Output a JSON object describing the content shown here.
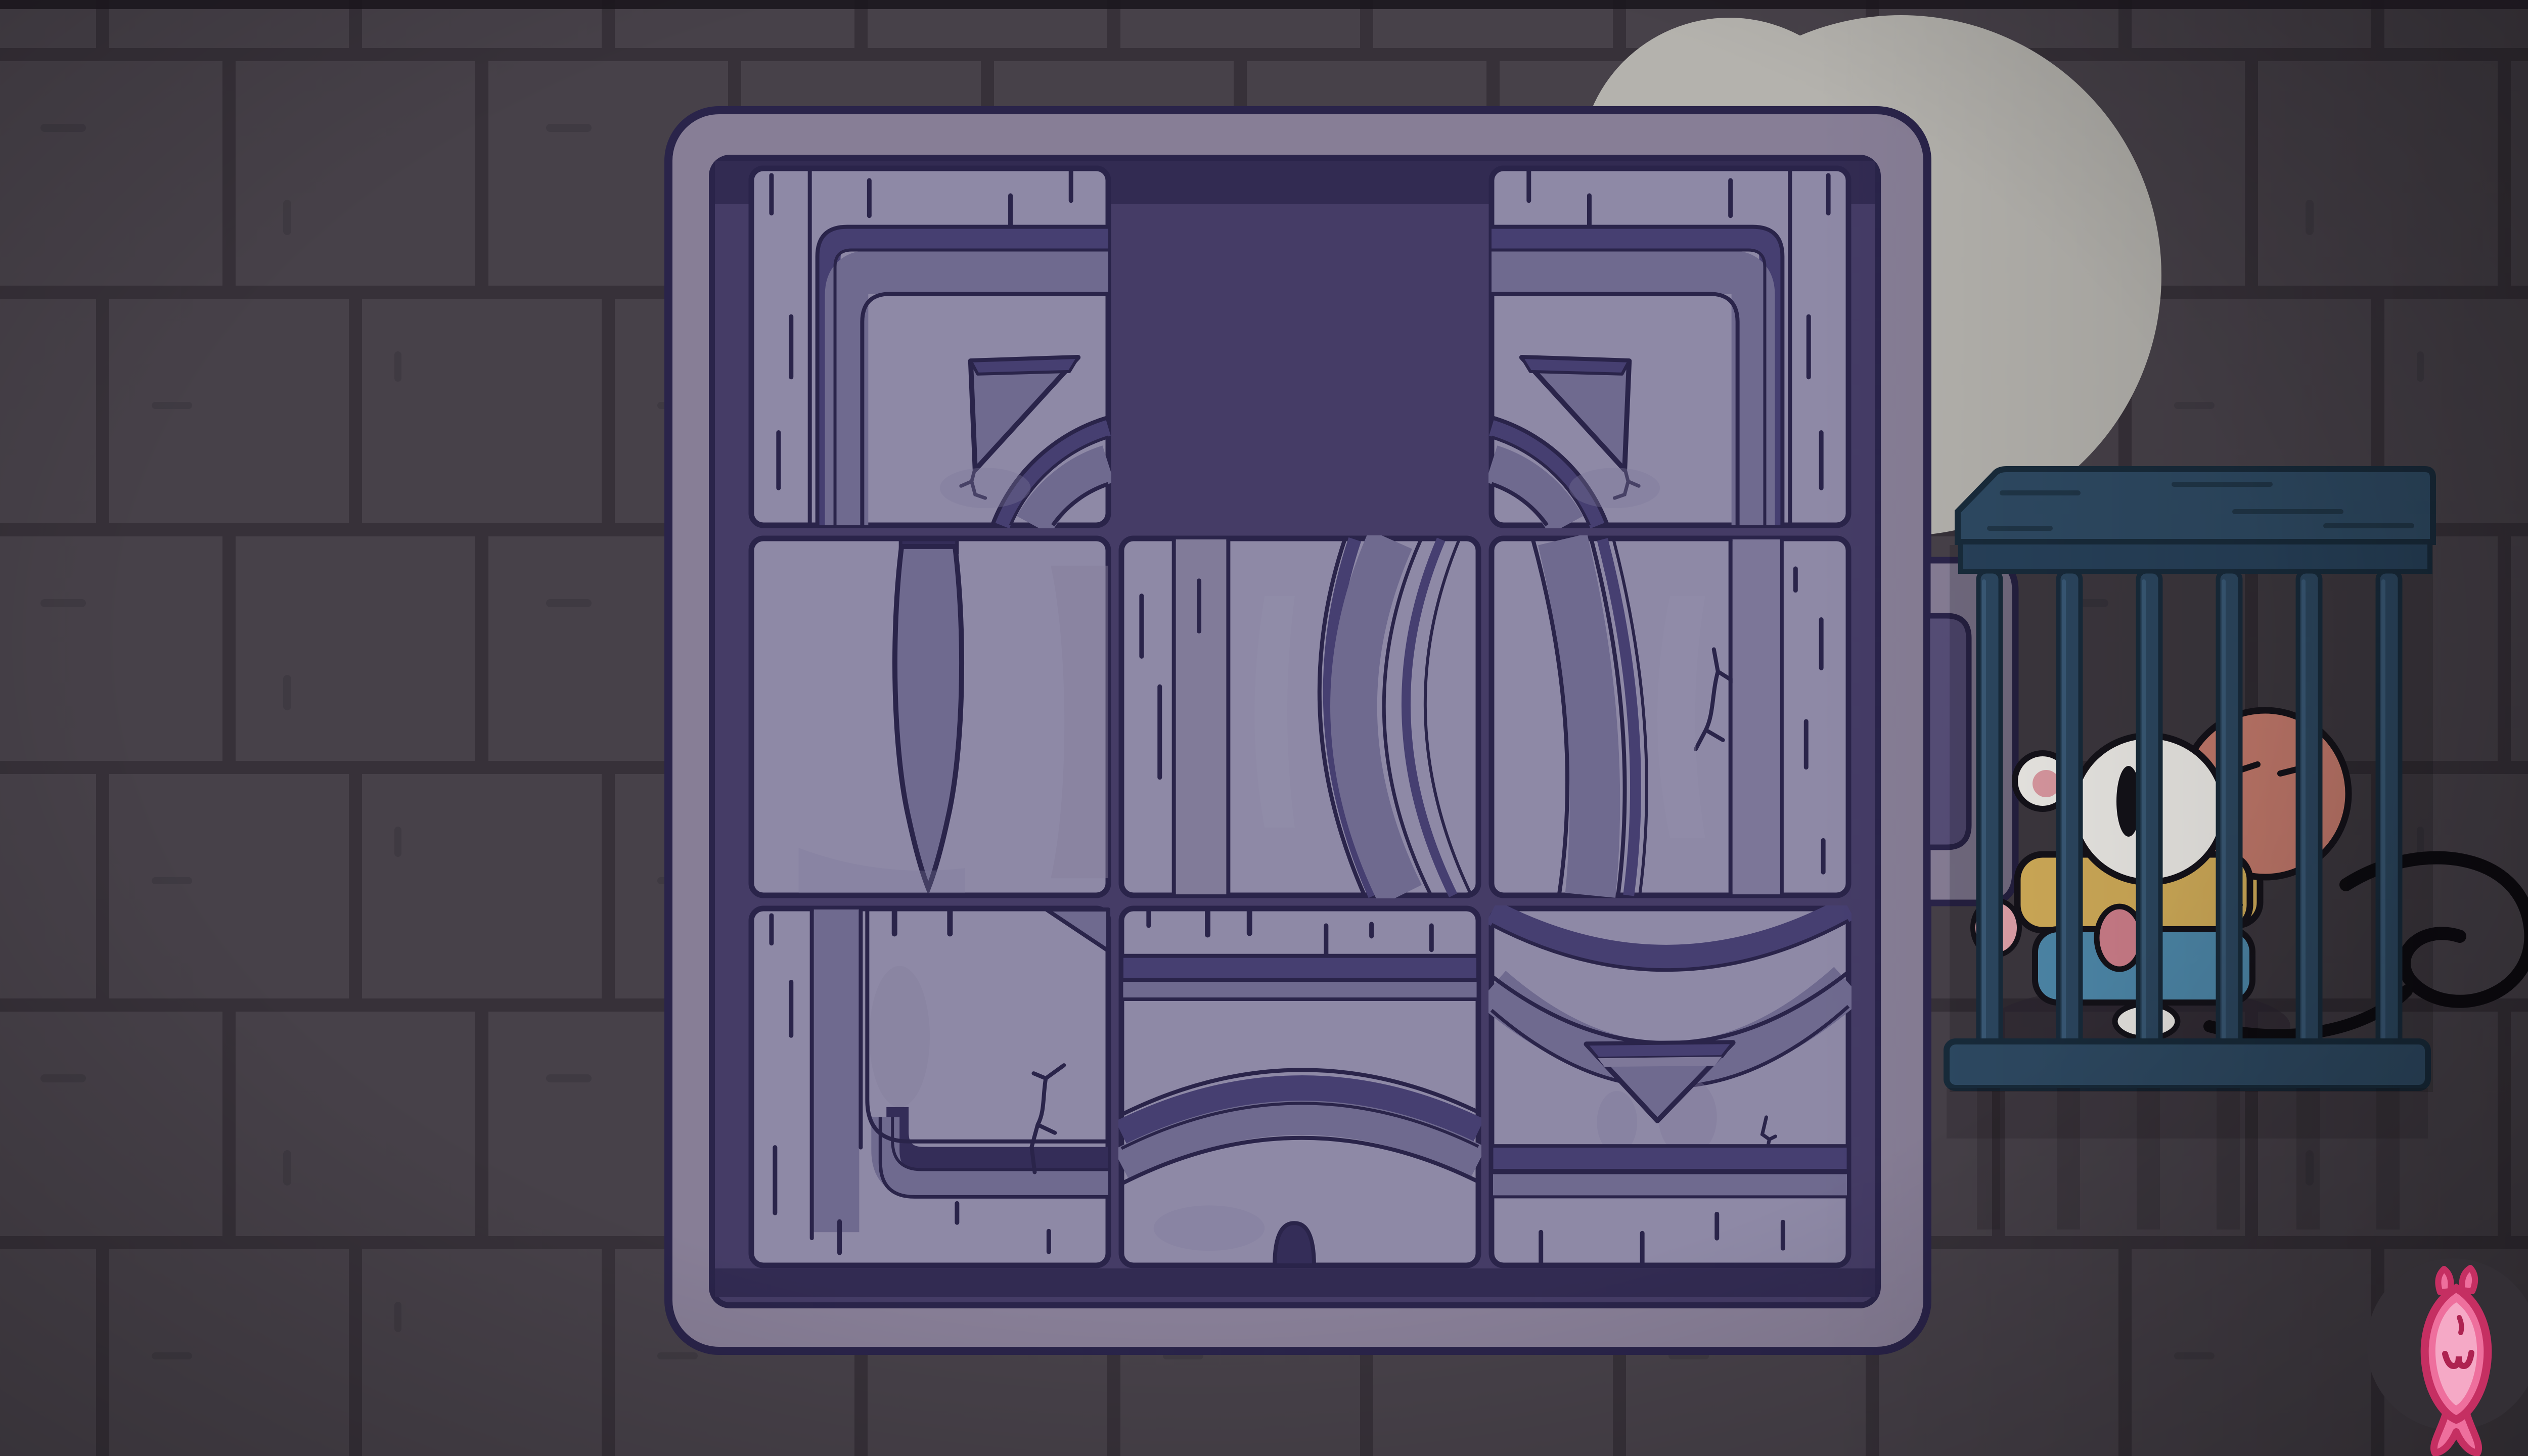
{
  "app": {
    "name": "sliding-tile-puzzle",
    "scene": "stone dungeon wall at night"
  },
  "palette": {
    "wall_brick": "#474149",
    "wall_mortar": "#373139",
    "moon_cloud": "#b4b2ad",
    "board_frame": "#877e96",
    "board_tray": "#453c66",
    "tray_shadow": "#322b52",
    "tile_base": "#8e89a6",
    "tile_outline": "#2a244a",
    "band_dark": "#463f71",
    "band_medium": "#6f6a8f",
    "band_deep": "#342d58",
    "cage_wood": "#2e4a63",
    "cage_outline": "#182b3b",
    "cat_white": "#edebe7",
    "monkey_skin": "#c47a6c",
    "outfit_yellow": "#d2ad59",
    "pants_blue": "#4e89ab",
    "fish_pink": "#ee6f9d",
    "fish_outline": "#c52f62",
    "button_circle": "#332f35"
  },
  "board": {
    "rows": 3,
    "cols": 3,
    "empty_cell": {
      "row": 0,
      "col": 1
    },
    "tiles": [
      {
        "id": "tile-1",
        "row": 0,
        "col": 0,
        "kind": "corner-top-left",
        "depicts": "frame corner bands with wedge pointer and arc"
      },
      {
        "id": "tile-2",
        "row": 0,
        "col": 2,
        "kind": "corner-top-right",
        "depicts": "mirrored corner bands with wedge pointer and arc"
      },
      {
        "id": "tile-3",
        "row": 1,
        "col": 0,
        "kind": "lens",
        "depicts": "tall pointed oval"
      },
      {
        "id": "tile-4",
        "row": 1,
        "col": 1,
        "kind": "stripes-arcs",
        "depicts": "planks and left rim of large rings"
      },
      {
        "id": "tile-5",
        "row": 1,
        "col": 2,
        "kind": "rings",
        "depicts": "right rim of large rings with crack"
      },
      {
        "id": "tile-6",
        "row": 2,
        "col": 0,
        "kind": "corner-bottom-left",
        "depicts": "bottom corner bands with branched crack"
      },
      {
        "id": "tile-7",
        "row": 2,
        "col": 1,
        "kind": "arch",
        "depicts": "arch bands with bottom notch"
      },
      {
        "id": "tile-8",
        "row": 2,
        "col": 2,
        "kind": "triangle-down",
        "depicts": "inverted triangle pointer under circle rim"
      }
    ]
  },
  "side_slot": {
    "present": true,
    "side": "right"
  },
  "cage": {
    "bars": 6,
    "characters": [
      {
        "name": "white-cat",
        "state": "worried, big oval eye, yellow collar, blue overalls"
      },
      {
        "name": "pink-monkey",
        "state": "eyes closed, long black tail curling outside the bars"
      }
    ]
  },
  "hud": {
    "fish_button": {
      "icon": "fish-icon",
      "action": "hint"
    }
  },
  "background": {
    "moon": true,
    "wall": "stone bricks"
  }
}
